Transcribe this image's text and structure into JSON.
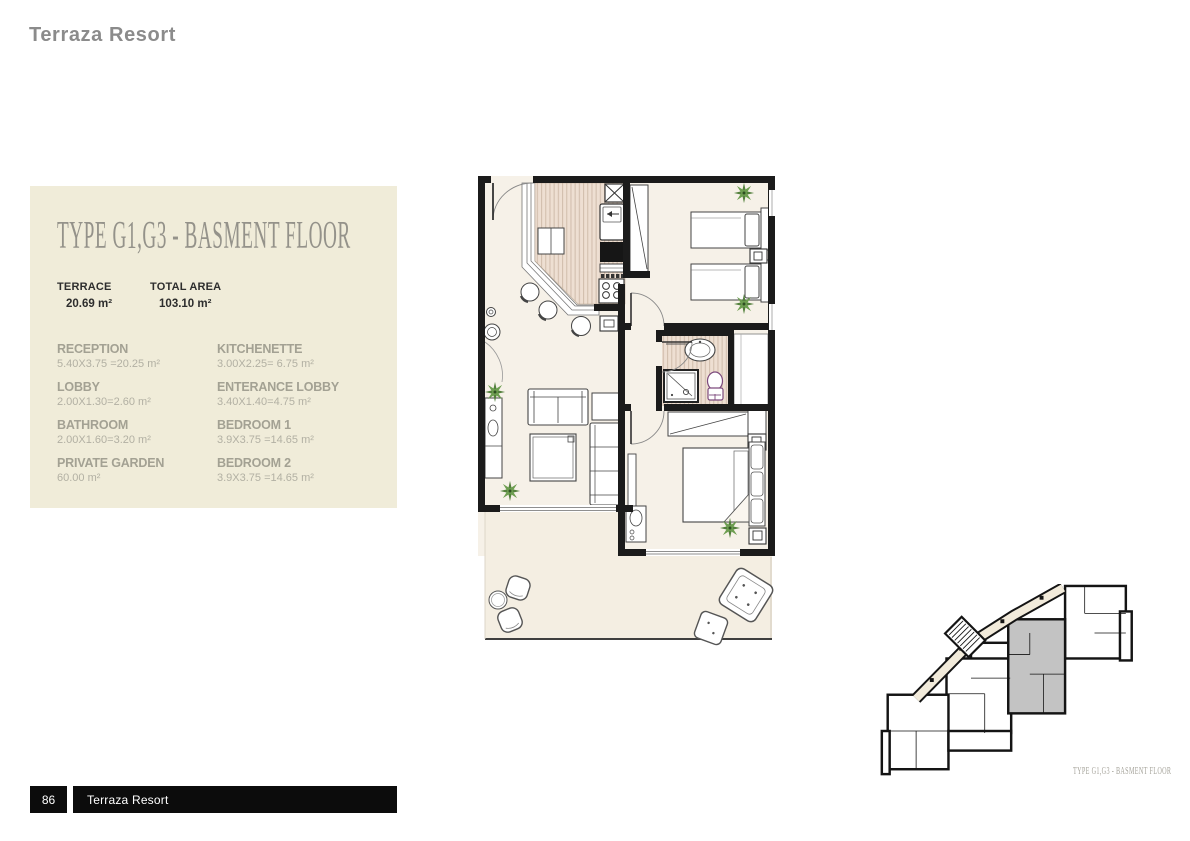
{
  "page": {
    "header_title": "Terraza Resort"
  },
  "card": {
    "title": "TYPE G1,G3 - BASMENT FLOOR",
    "stats": [
      {
        "label": "TERRACE",
        "value": "20.69 m²"
      },
      {
        "label": "TOTAL AREA",
        "value": "103.10 m²"
      }
    ],
    "rooms": [
      {
        "name": "RECEPTION",
        "dims": "5.40X3.75 =20.25 m²"
      },
      {
        "name": "LOBBY",
        "dims": "2.00X1.30=2.60 m²"
      },
      {
        "name": "BATHROOM",
        "dims": "2.00X1.60=3.20 m²"
      },
      {
        "name": "PRIVATE GARDEN",
        "dims": "60.00 m²"
      },
      {
        "name": "KITCHENETTE",
        "dims": "3.00X2.25= 6.75 m²"
      },
      {
        "name": "ENTERANCE LOBBY",
        "dims": "3.40X1.40=4.75 m²"
      },
      {
        "name": "BEDROOM 1",
        "dims": "3.9X3.75 =14.65 m²"
      },
      {
        "name": "BEDROOM 2",
        "dims": "3.9X3.75 =14.65 m²"
      }
    ]
  },
  "key_plan": {
    "caption": "TYPE G1,G3 - BASMENT FLOOR",
    "highlight_color": "#c3c3c3"
  },
  "footer": {
    "page_number": "86",
    "label": "Terraza Resort"
  },
  "colors": {
    "card_bg": "#f0ecd9",
    "wall": "#1b1b1b",
    "floor": "#f6f1e8",
    "stripe_base": "#eedfd2",
    "stripe_line": "#d2bfae",
    "plant_green": "#5f8f46",
    "footer_bg": "#0c0c0c",
    "title_gray": "#94928a"
  }
}
